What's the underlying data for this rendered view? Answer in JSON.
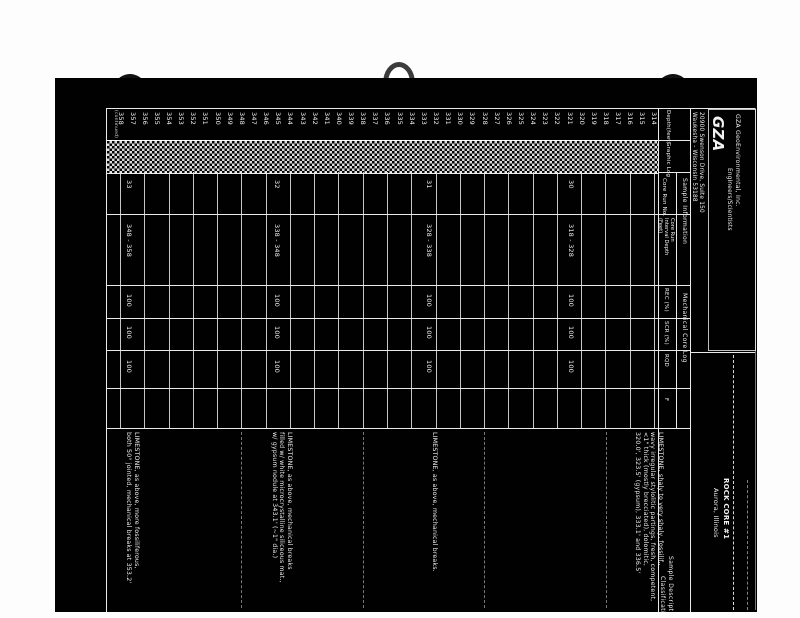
{
  "document": {
    "company": {
      "logo_text": "GZA",
      "name": "GZA GeoEnvironmental, Inc.",
      "tagline": "Engineers/Scientists",
      "address_line1": "20900 Swenson Drive, Suite 150",
      "address_line2": "Waukesha - Wisconsin 53188"
    },
    "title_block": {
      "line1": "ROCK CORE #1",
      "line2": "Aurora, Illinois"
    },
    "side_note": "(continued)",
    "column_headers": {
      "depth": "Depth(feet)",
      "graphic_log": "Graphic Log",
      "sample_information": "Sample Information",
      "core_run_no": "Core Run No.",
      "core_run_interval_lines": [
        "Core Run",
        "Interval Depth",
        "(Feet)"
      ],
      "mechanical_core_log": "Mechanical Core Log",
      "rec_pct": "REC (%)",
      "scr_pct": "SCR (%)",
      "rqd": "RQD",
      "fractures": "F",
      "sample_description": "Sample Description",
      "classification": "Classification"
    },
    "depth_scale": {
      "unit": "feet",
      "shallow_end": 314,
      "deep_end": 358,
      "tick_interval": 1,
      "ticks": [
        358,
        357,
        356,
        355,
        354,
        353,
        352,
        351,
        350,
        349,
        348,
        347,
        346,
        345,
        344,
        343,
        342,
        341,
        340,
        339,
        338,
        337,
        336,
        335,
        334,
        333,
        332,
        331,
        330,
        329,
        328,
        327,
        326,
        325,
        324,
        323,
        322,
        321,
        320,
        319,
        318,
        317,
        316,
        315,
        314
      ]
    },
    "core_runs": [
      {
        "run_no": "33",
        "interval_depth": "348 - 358",
        "rec_pct": "100",
        "scr_pct": "100",
        "rqd": "100",
        "f": ""
      },
      {
        "run_no": "32",
        "interval_depth": "338 - 348",
        "rec_pct": "100",
        "scr_pct": "100",
        "rqd": "100",
        "f": ""
      },
      {
        "run_no": "31",
        "interval_depth": "328 - 338",
        "rec_pct": "100",
        "scr_pct": "100",
        "rqd": "100",
        "f": ""
      },
      {
        "run_no": "30",
        "interval_depth": "318 - 328",
        "rec_pct": "100",
        "scr_pct": "100",
        "rqd": "100",
        "f": ""
      }
    ],
    "descriptions": [
      {
        "lines": [
          "LIMESTONE, as above, more fossiliferous,",
          "both 50° jointed, mechanical breaks at 353.2'"
        ]
      },
      {
        "lines": [
          "LIMESTONE, as above, mechanical breaks",
          "filled w/ white microcrystalline siliceous mat.,",
          "w/ gypsum nodule at 343.1' (~1\" dia.)"
        ]
      },
      {
        "lines": [
          "LIMESTONE, as above, mechanical breaks."
        ]
      },
      {
        "lines": [
          "LIMESTONE, shaly to very shaly, fossilif.,",
          "wavy irregular stylolitic partings, fresh, competent,",
          "<1\" thick (mostly brecciated), dolomitic,",
          "320.0', 323.5' (gypsum), 333.1' and 336.5'"
        ]
      }
    ],
    "colors": {
      "page_bg": "#010101",
      "ink": "#f2f2f2",
      "margin_bg": "#fdfdfd"
    }
  }
}
